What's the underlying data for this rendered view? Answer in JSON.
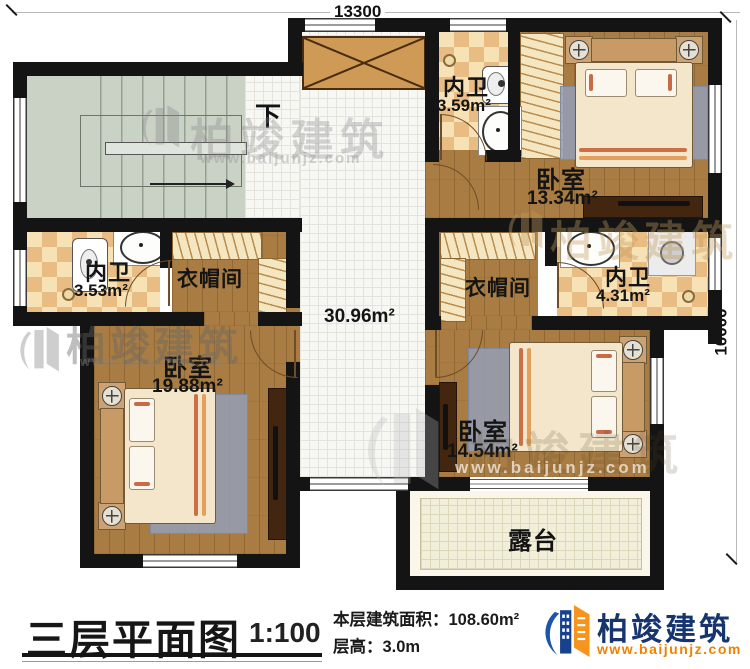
{
  "dimensions": {
    "top": "13300",
    "right": "10000"
  },
  "stairs": {
    "down_label": "下"
  },
  "rooms": {
    "bath_top": {
      "name": "内卫",
      "area": "3.59m²"
    },
    "bedroom_top_right": {
      "name": "卧室",
      "area": "13.34m²"
    },
    "closet_left": {
      "name": "衣帽间"
    },
    "closet_right": {
      "name": "衣帽间"
    },
    "bath_left": {
      "name": "内卫",
      "area": "3.53m²"
    },
    "bath_right": {
      "name": "内卫",
      "area": "4.31m²"
    },
    "hall": {
      "area": "30.96m²"
    },
    "bedroom_bottom_left": {
      "name": "卧室",
      "area": "19.88m²"
    },
    "bedroom_bottom_right": {
      "name": "卧室",
      "area": "14.54m²"
    },
    "terrace": {
      "name": "露台"
    }
  },
  "title_block": {
    "title": "三层平面图",
    "scale": "1:100",
    "area_label": "本层建筑面积：",
    "area_value": "108.60m²",
    "height_label": "层高：",
    "height_value": "3.0m"
  },
  "brand": {
    "name": "柏竣建筑",
    "url": "www.baijunjz.com"
  },
  "watermark": {
    "name": "柏竣建筑",
    "url": "www.baijunjz.com"
  },
  "colors": {
    "wall": "#141414",
    "wood": "#a87c42",
    "checker_dark": "#e8bc82",
    "stairs": "#c9d2c5",
    "brand_blue": "#16356f",
    "brand_orange": "#ef8200"
  }
}
